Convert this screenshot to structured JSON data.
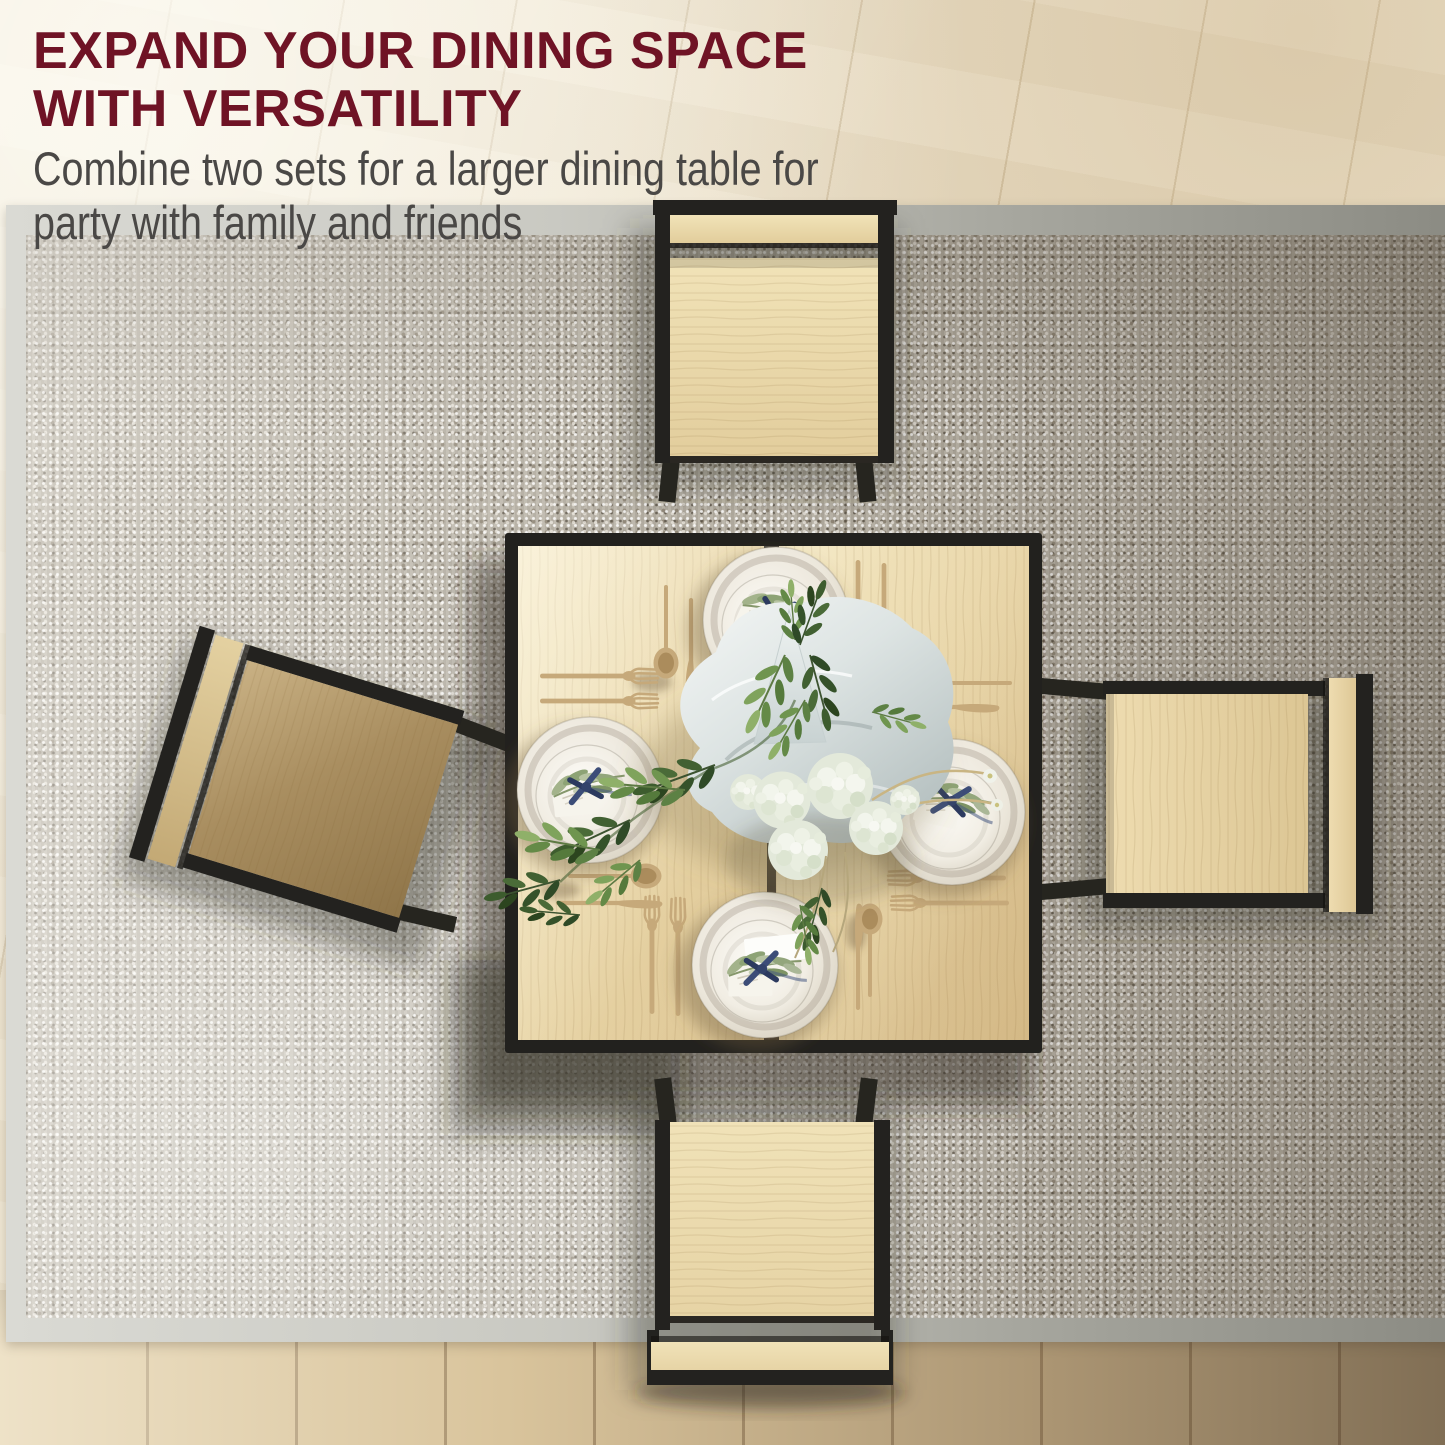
{
  "title": {
    "line1": "EXPAND YOUR DINING SPACE",
    "line2": "WITH VERSATILITY"
  },
  "subtitle": {
    "line1": "Combine two sets for a larger dining table for",
    "line2": "party with family and friends"
  },
  "palette": {
    "title_color": "#6f1325",
    "subtitle_color": "#4a4846",
    "table_frame_black": "#22211e",
    "table_wood": "#e7d4a6",
    "stool_wood": "#ead8ab",
    "rug_base": "#b7b1a5",
    "rug_binding": "#c9c9c2",
    "floor_light": "#ebe0c9",
    "floor_dark": "#9d8263",
    "cutlery_gold": "#c6a97a",
    "plate_white": "#f1ede4",
    "napkin_gray": "#ccd6d6",
    "leaf_green": "#4c7038",
    "flower_white": "#eef1e8",
    "ribbon_navy": "#33436b"
  },
  "scene_alt": "Top-down view of a square two-part dining table with black metal frame and oak top set for four with white plates, gold cutlery, greenery and white hydrangea centerpiece, surrounded by four oak stools on a gray woven rug over a light oak floor"
}
